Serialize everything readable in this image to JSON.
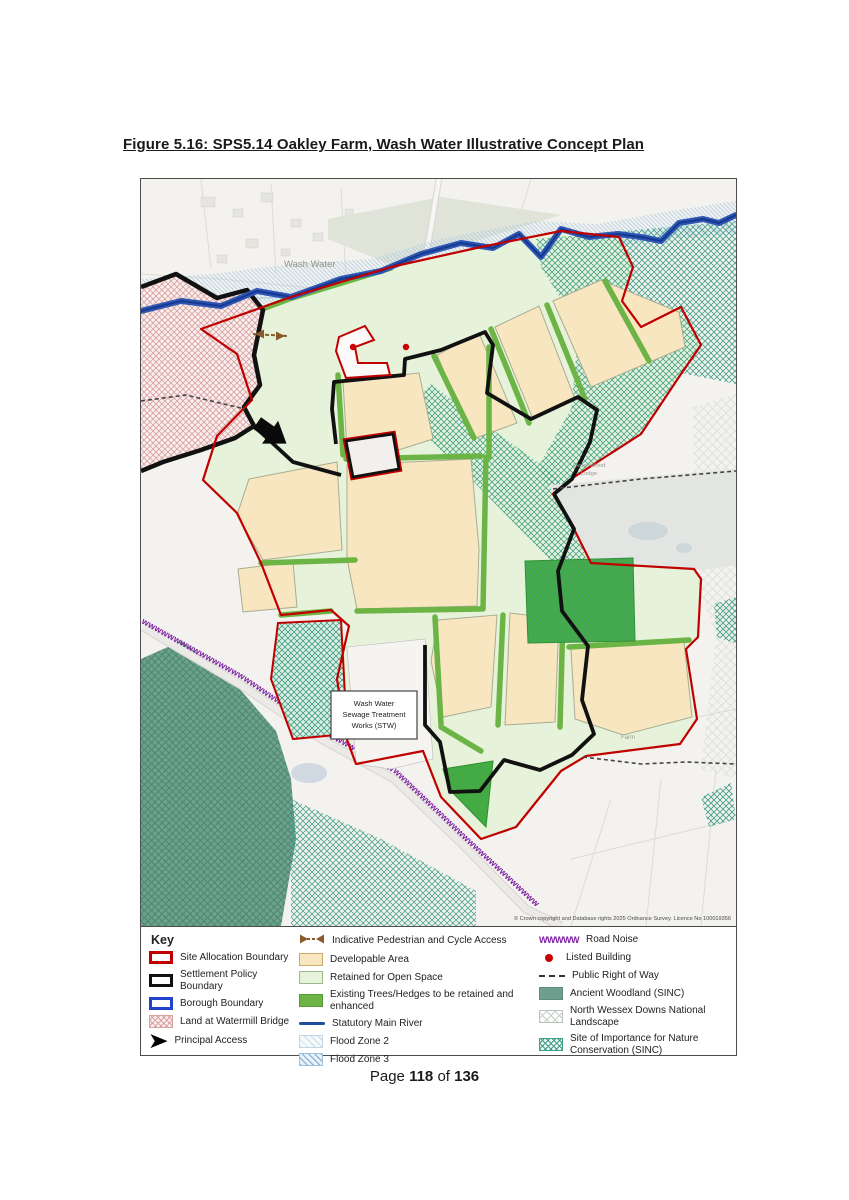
{
  "title": "Figure 5.16: SPS5.14 Oakley Farm, Wash Water Illustrative Concept Plan",
  "map": {
    "labels": {
      "wash_water": "Wash Water",
      "cedar_wood_1": "Cedar Wood",
      "cedar_wood_2": "Lodge",
      "farm": "Farm",
      "stw_1": "Wash Water",
      "stw_2": "Sewage Treatment",
      "stw_3": "Works (STW)",
      "copyright": "© Crown copyright and Database rights 2025 Ordnance Survey. Licence No 100019356",
      "road_noise": "wwwwwwwwwwwwwwwwwwwwwwwwwwwwwwwwwwwwwwwwwwwwwwwwwwwwwwwwwwwwwwwwwwwwwwwwwwww"
    },
    "colors": {
      "site_allocation_red": "#c00000",
      "settlement_black": "#111111",
      "borough_blue": "#2244cc",
      "statutory_river_blue": "#1f4e9c",
      "developable_tan": "#f8e6c0",
      "open_space_green": "#e6f3da",
      "trees_green": "#6cb445",
      "ancient_woodland_teal": "#6aa28c",
      "sinc_teal": "#3f9e86",
      "road_noise_purple": "#7d1fa2",
      "listed_building_red": "#cc0000",
      "watermill_pink": "#d9a3a3",
      "flood_blue": "#a9c8e0"
    }
  },
  "key": {
    "heading": "Key",
    "site_allocation": "Site Allocation Boundary",
    "settlement_policy": "Settlement Policy Boundary",
    "borough": "Borough Boundary",
    "watermill": "Land at Watermill Bridge",
    "principal_access": "Principal Access",
    "ped_cycle": "Indicative Pedestrian and Cycle Access",
    "developable": "Developable Area",
    "open_space": "Retained for Open Space",
    "trees": "Existing Trees/Hedges to be retained and enhanced",
    "river": "Statutory Main River",
    "fz2": "Flood Zone 2",
    "fz3": "Flood Zone 3",
    "road_noise_glyph": "WWWWW",
    "road_noise": "Road Noise",
    "listed": "Listed Building",
    "prow": "Public Right of Way",
    "ancient": "Ancient Woodland (SINC)",
    "nwd": "North Wessex Downs National Landscape",
    "sinc": "Site of Importance for Nature Conservation (SINC)"
  },
  "footer": {
    "prefix": "Page",
    "page": "118",
    "conj": "of",
    "total": "136"
  }
}
